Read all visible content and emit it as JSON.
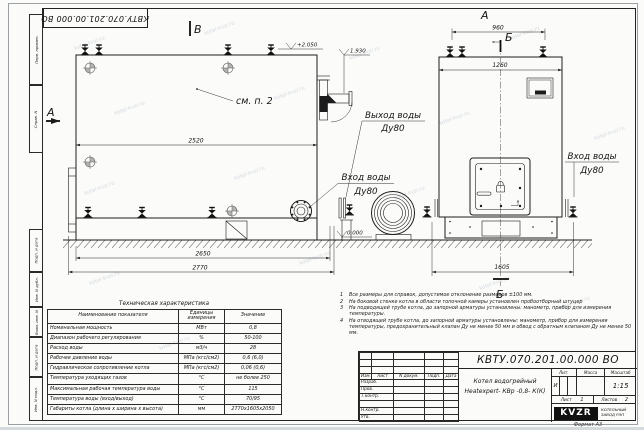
{
  "sheet": {
    "stamp": "КВТУ.070.201.00.000 ВО",
    "watermark": "kotel-kvzr.ru",
    "margin_labels": [
      "Перв. примен.",
      "Справ. N",
      "Подп. и дата",
      "Инв. N дубл.",
      "Взам. инв. N",
      "Подп. и дата",
      "Инв. N подл."
    ]
  },
  "drawing": {
    "views": {
      "front": "В",
      "side": "А",
      "section_a": "А",
      "section_b_top": "Б",
      "section_b_bottom": "Б"
    },
    "dims": {
      "d2520": "2520",
      "d2650": "2650",
      "d2770": "2770",
      "d960": "960",
      "d1260": "1260",
      "d1605": "1605"
    },
    "elev": {
      "top": "+2.050",
      "mid": "1.930",
      "zero": "0.000"
    },
    "labels": {
      "see_note": "см. п. 2",
      "outlet_l1": "Выход воды",
      "outlet_l2": "Ду80",
      "inlet_left_l1": "Вход воды",
      "inlet_left_l2": "Ду80",
      "inlet_right_l1": "Вход воды",
      "inlet_right_l2": "Ду80"
    }
  },
  "tech_table": {
    "title": "Техническая характеристика",
    "headers": [
      "Наименование показателя",
      "Единицы измерения",
      "Значение"
    ],
    "rows": [
      [
        "Номинальная мощность",
        "МВт",
        "0,8"
      ],
      [
        "Диапазон рабочего регулирования",
        "%",
        "50-100"
      ],
      [
        "Расход воды",
        "м3/ч",
        "28"
      ],
      [
        "Рабочее давление воды",
        "МПа (кгс/см2)",
        "0,6 (6,0)"
      ],
      [
        "Гидравлическое сопротивление котла",
        "МПа (кгс/см2)",
        "0,06 (0,6)"
      ],
      [
        "Температура уходящих газов",
        "°С",
        "не более 250"
      ],
      [
        "Максимальная рабочая температура воды",
        "°С",
        "115"
      ],
      [
        "Температура воды (вход/выход)",
        "°С",
        "70/95"
      ],
      [
        "Габариты котла (длина х ширина х высота)",
        "мм",
        "2770х1605х2050"
      ]
    ]
  },
  "notes": {
    "items": [
      {
        "n": "1",
        "text": "Все размеры для справок, допустимое отклонение размеров ±100 мм."
      },
      {
        "n": "2",
        "text": "На боковой стенке котла в области топочной камеры установлен пробоотборный штуцер"
      },
      {
        "n": "3",
        "text": "На подводящей трубе котла, до запорной арматуры установлены: манометр, прибор для измерения температуры."
      },
      {
        "n": "4",
        "text": "На отводящей трубе котла, до запорной арматуры установлены: манометр, прибор для измерения температуры, предохранительный клапан Ду не менее 50 мм и обвод с обратным клапаном Ду не менее 50 мм."
      }
    ]
  },
  "title_block": {
    "doc_number": "КВТУ.070.201.00.000 ВО",
    "product_line1": "Котел водогрейный",
    "product_line2": "Heatexpert- КВр -0,8- К(К)",
    "cols": {
      "izm": "Изм.",
      "list": "Лист",
      "ndoc": "N докум.",
      "podp": "Подп.",
      "data": "Дата"
    },
    "rows": {
      "razrab": "Разраб.",
      "prov": "Пров.",
      "tkontr": "Т.контр.",
      "nkontr": "Н.контр.",
      "utv": "Утв."
    },
    "lit_label": "Лит.",
    "lit_value": "И",
    "massa_label": "Масса",
    "masshtab_label": "Масштаб",
    "scale": "1:15",
    "list_label": "Лист",
    "list_value": "1",
    "listov_label": "Листов",
    "listov_value": "2",
    "logo": "KVZR",
    "company_line1": "КОТЕЛЬНЫЙ",
    "company_line2": "ЗАВОД РЭП",
    "format": "Формат  А3"
  }
}
